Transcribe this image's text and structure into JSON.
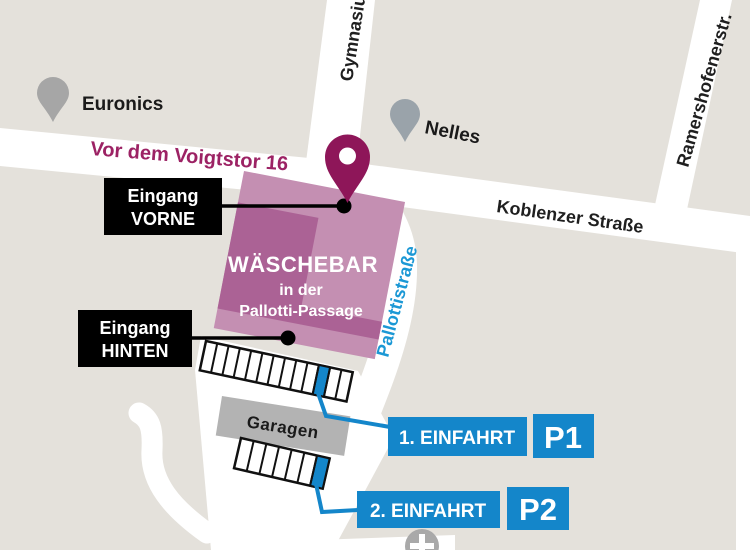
{
  "map": {
    "colors": {
      "background": "#e4e1db",
      "street": "#ffffff",
      "brand_magenta": "#8e1659",
      "building_light": "#c48fb2",
      "building_dark": "#ab6295",
      "accent_blue": "#1486ca",
      "garage_gray": "#b3b3b3",
      "pin_gray": "#a6a6a6",
      "box_black": "#000000"
    },
    "streets": {
      "voigtstor": "Vor dem Voigtstor 16",
      "koblenzer": "Koblenzer Straße",
      "gymnasium": "Gymnasiumstraße",
      "ramershofener": "Ramershofenerstr.",
      "pallotti": "Pallottistraße"
    },
    "pois": {
      "euronics": "Euronics",
      "nelles": "Nelles",
      "garages": "Garagen"
    },
    "building": {
      "title": "WÄSCHEBAR",
      "subtitle_line1": "in der",
      "subtitle_line2": "Pallotti-Passage"
    },
    "entrances": {
      "front": {
        "line1": "Eingang",
        "line2": "VORNE"
      },
      "back": {
        "line1": "Eingang",
        "line2": "HINTEN"
      }
    },
    "parking": {
      "entry1": {
        "label": "1. EINFAHRT",
        "badge": "P1"
      },
      "entry2": {
        "label": "2. EINFAHRT",
        "badge": "P2"
      }
    }
  }
}
